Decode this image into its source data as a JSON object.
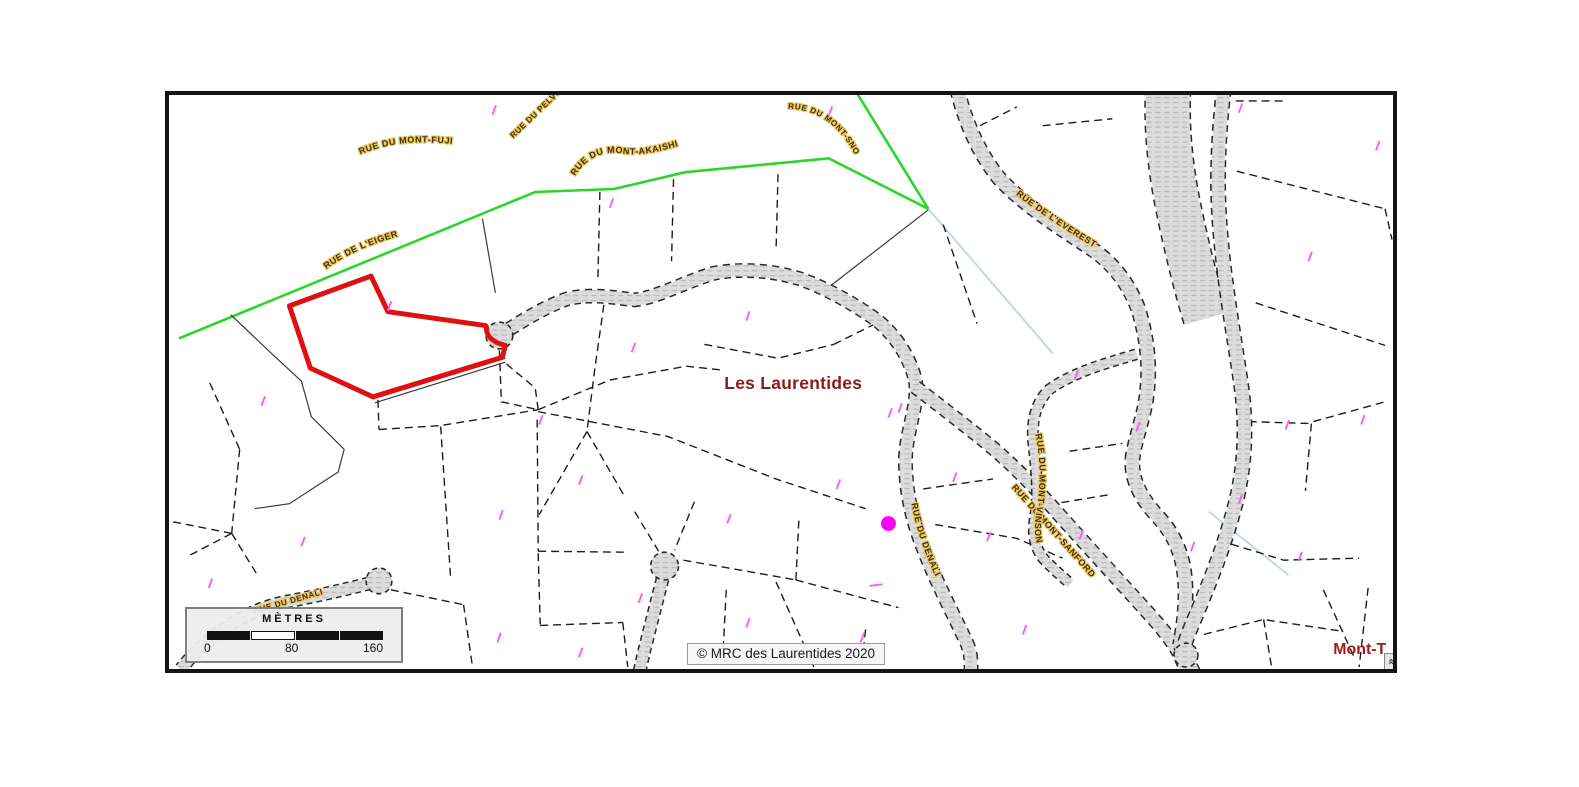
{
  "map": {
    "region_label": "Les Laurentides",
    "truncated_label": "Mont-T",
    "attribution": "© MRC des Laurentides 2020",
    "streets": {
      "mont_fuji": "RUE DU MONT-FUJI",
      "pelvoux": "RUE DU PELVOUX",
      "mont_akaishi": "RUE DU MONT-AKAISHI",
      "eiger": "RUE DE L'EIGER",
      "mont_snow": "RUE DU MONT-SNOW",
      "everest": "RUE DE L'EVEREST",
      "denali": "RUE DU DENALI",
      "denali_west": "RUE DU DENALI",
      "mont_sanford": "RUE DU MONT-SANFORD",
      "mont_vinson": "RUE DU MONT-VINSON"
    },
    "scale_bar": {
      "title": "MÈTRES",
      "tick_labels": [
        "0",
        "80",
        "160"
      ]
    },
    "colors": {
      "selected_parcel_outline": "#DE1010",
      "boundary_green": "#2BD62B",
      "hydro_line_blue": "#C3D6EB",
      "street_label_text": "#433000",
      "street_label_halo": "#E9C86B",
      "region_label_text": "#8B1A1A",
      "poi_dot_magenta": "#FF00FF",
      "road_fill": "#DCDCDC",
      "parcel_line": "#1C1C1C",
      "frame_border": "#141414"
    }
  }
}
